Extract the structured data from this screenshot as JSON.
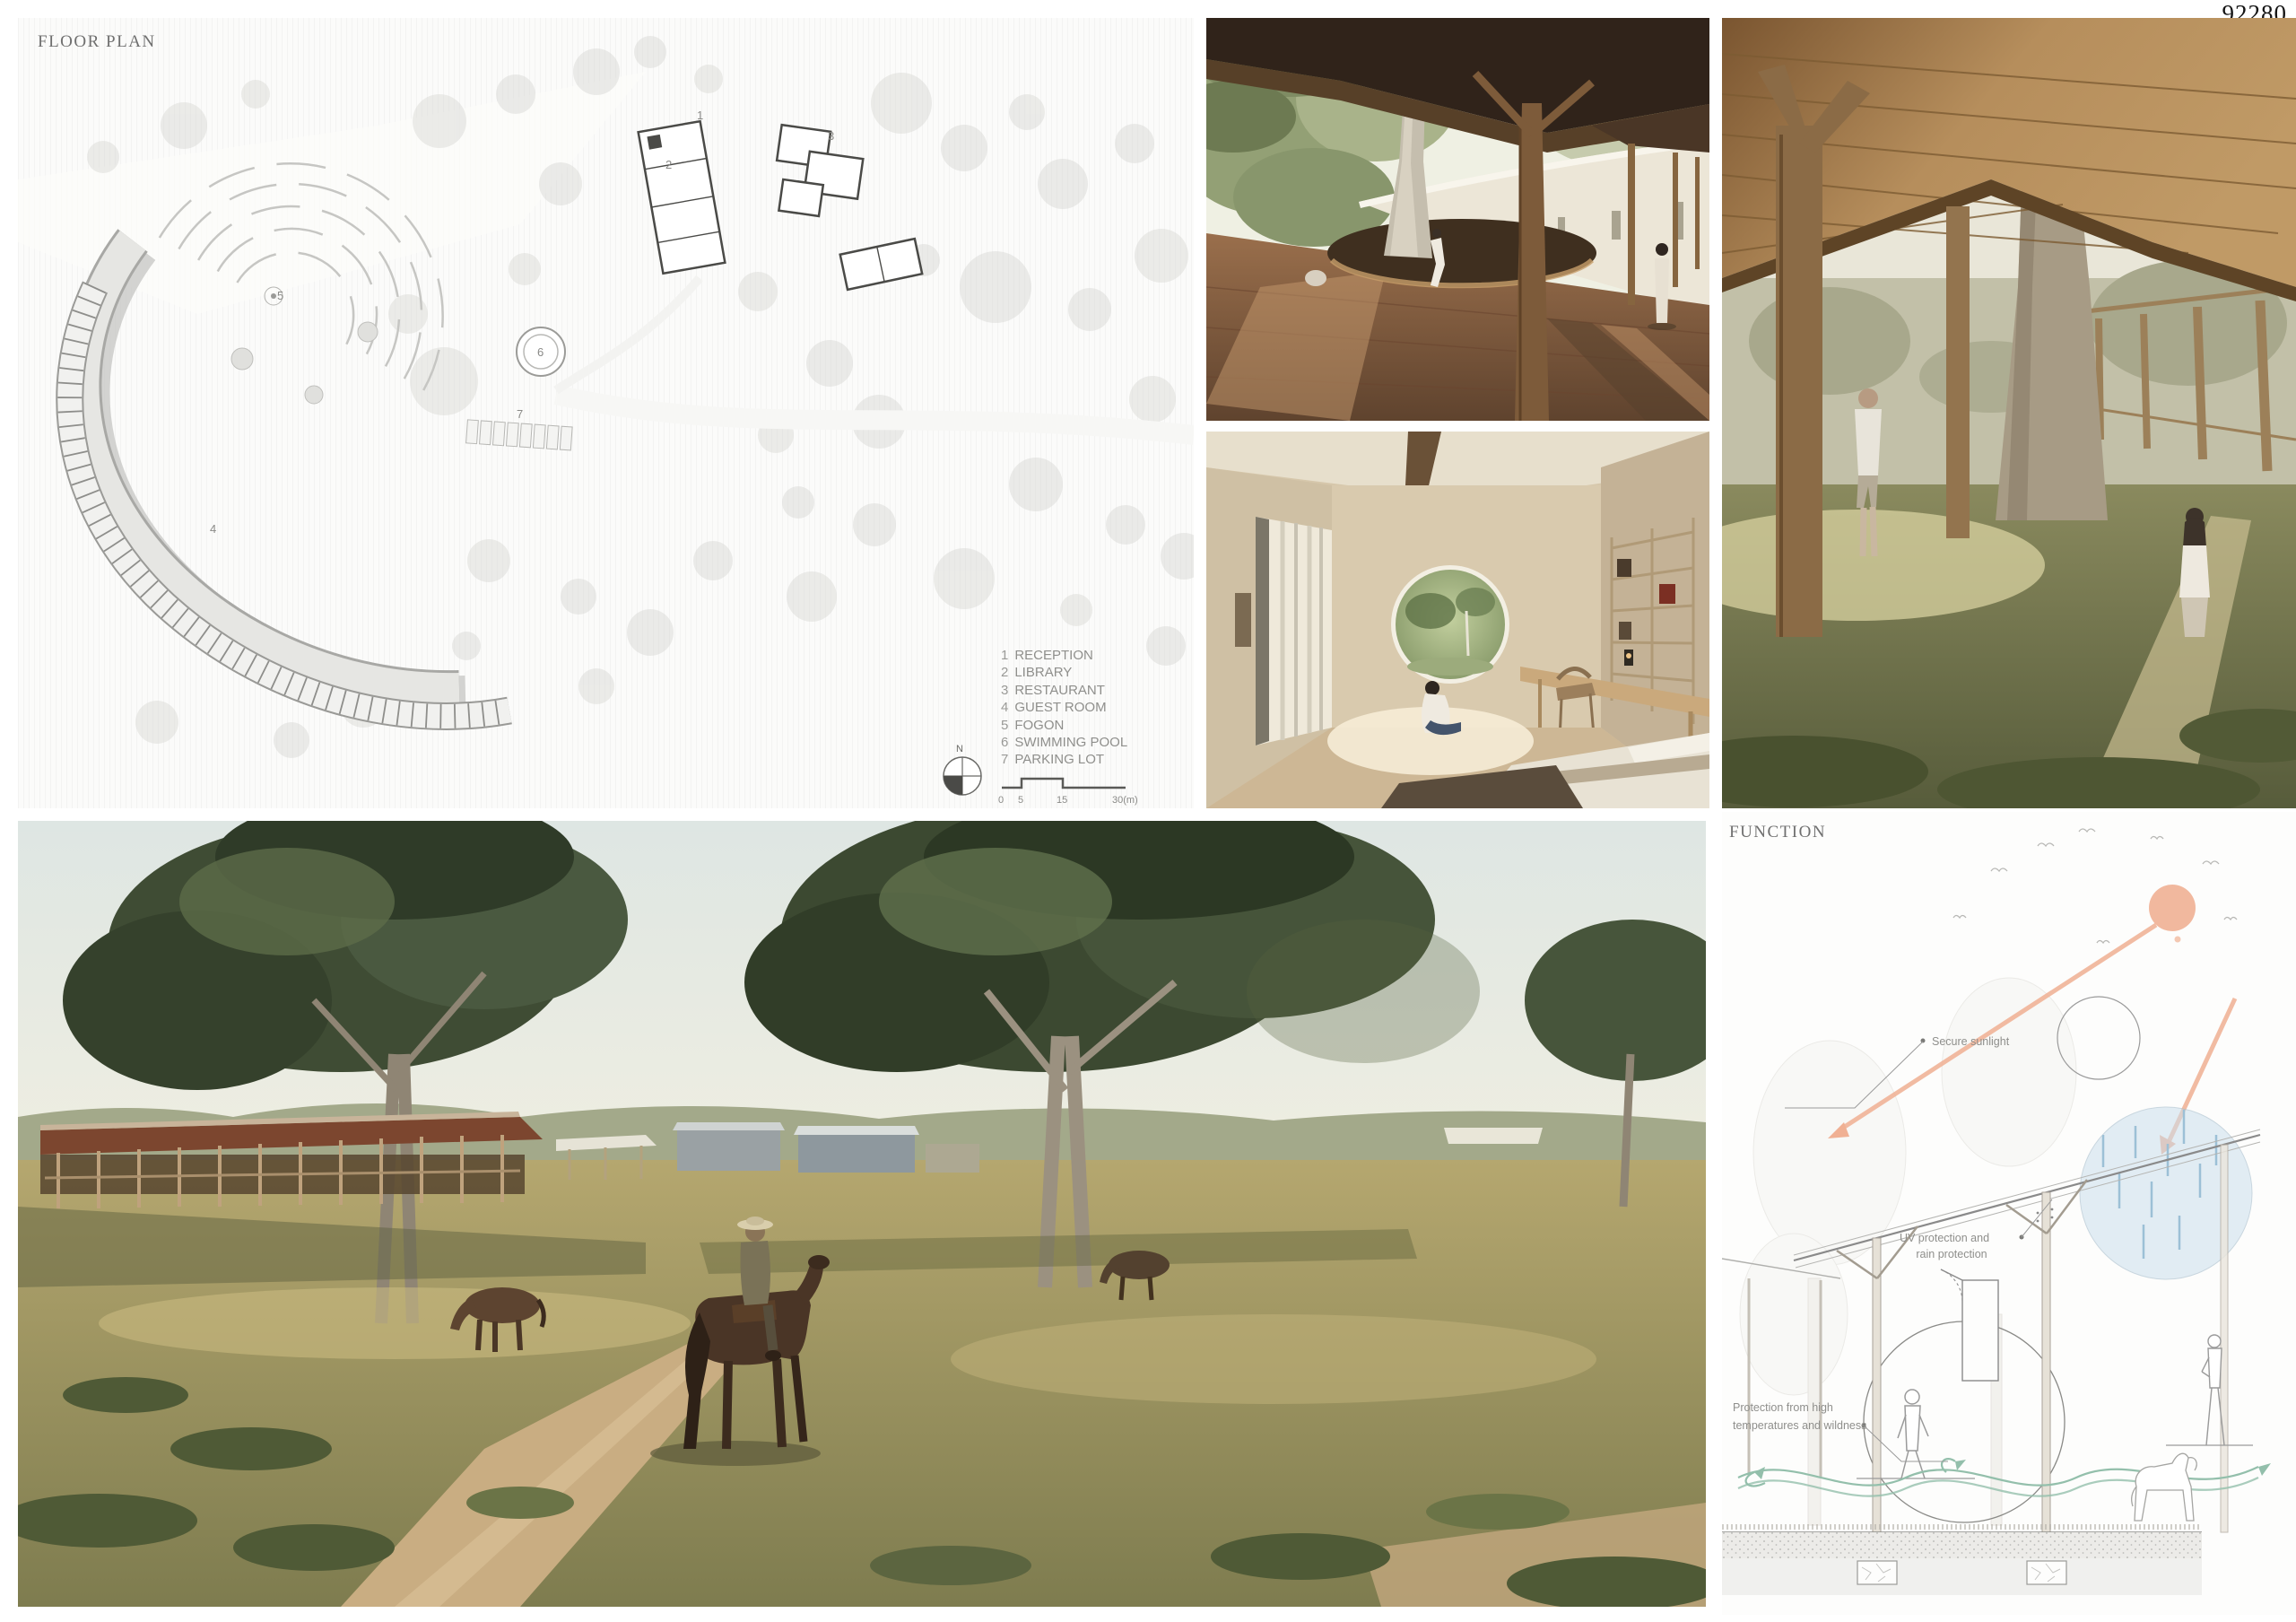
{
  "page": {
    "id_number": "92280"
  },
  "floor_plan": {
    "title": "FLOOR PLAN",
    "legend": [
      {
        "num": "1",
        "label": "RECEPTION"
      },
      {
        "num": "2",
        "label": "LIBRARY"
      },
      {
        "num": "3",
        "label": "RESTAURANT"
      },
      {
        "num": "4",
        "label": "GUEST ROOM"
      },
      {
        "num": "5",
        "label": "FOGON"
      },
      {
        "num": "6",
        "label": "SWIMMING POOL"
      },
      {
        "num": "7",
        "label": "PARKING LOT"
      }
    ],
    "plan_numbers": [
      "1",
      "2",
      "3",
      "4",
      "5",
      "6",
      "7"
    ],
    "north_label": "N",
    "scale_bar": {
      "ticks": [
        "0",
        "5",
        "15",
        "30(m)"
      ]
    }
  },
  "function_diagram": {
    "title": "FUNCTION",
    "annotations": {
      "sunlight": "Secure sunlight",
      "uv_line1": "UV protection and",
      "uv_line2": "rain protection",
      "protection_line1": "Protection from high",
      "protection_line2": "temperatures and wildness"
    },
    "colors": {
      "sun": "#f0b093",
      "rain": "#cbdfec",
      "wind": "#93bfab"
    }
  }
}
